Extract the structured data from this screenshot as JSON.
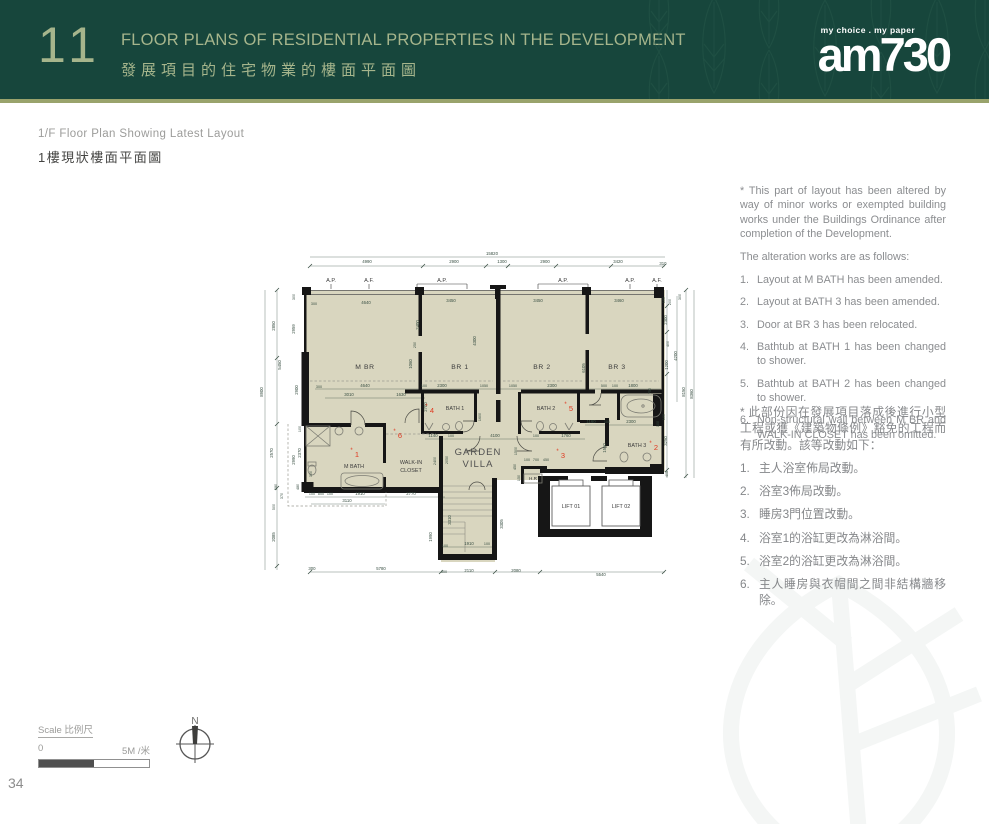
{
  "header": {
    "number": "11",
    "title_en": "FLOOR PLANS OF RESIDENTIAL PROPERTIES IN THE DEVELOPMENT",
    "title_zh": "發展項目的住宅物業的樓面平面圖",
    "logo_tagline": "my choice . my paper",
    "logo_name": "am730",
    "colors": {
      "band": "#17463c",
      "rule": "#99a36c",
      "title": "#a6b58c"
    }
  },
  "subtitle": {
    "en": "1/F Floor Plan Showing Latest Layout",
    "zh": "1樓現狀樓面平面圖"
  },
  "notes_en": {
    "intro": "* This part of layout has been altered by way of minor works or exempted building works under the Buildings Ordinance after completion of the Development.",
    "lead": "The alteration works are as follows:",
    "items": [
      "Layout at M BATH has been amended.",
      "Layout at BATH 3 has been amended.",
      "Door at BR 3 has been relocated.",
      "Bathtub at BATH 1 has been changed to shower.",
      "Bathtub at BATH 2 has been changed to shower.",
      "Non-structural wall between M BR and WALK-IN CLOSET has been omitted."
    ]
  },
  "notes_zh": {
    "intro": "* 此部份因在發展項目落成後進行小型工程或獲《建築物條例》豁免的工程而有所改動。該等改動如下：",
    "items": [
      "主人浴室佈局改動。",
      "浴室3佈局改動。",
      "睡房3門位置改動。",
      "浴室1的浴缸更改為淋浴間。",
      "浴室2的浴缸更改為淋浴間。",
      "主人睡房與衣帽間之間非結構牆移除。"
    ]
  },
  "scale": {
    "label": "Scale 比例尺",
    "zero": "0",
    "five": "5M /米"
  },
  "compass": {
    "north": "N"
  },
  "page_number": "34",
  "plan": {
    "marker_prefix": "*",
    "colors": {
      "floor": "#d9d6bf",
      "wall": "#161616",
      "dim": "#3a5044",
      "marker": "#e0381f"
    },
    "markers": [
      {
        "n": "1",
        "x": 101,
        "y": 217
      },
      {
        "n": "2",
        "x": 400,
        "y": 210
      },
      {
        "n": "3",
        "x": 307,
        "y": 218
      },
      {
        "n": "4",
        "x": 176,
        "y": 173
      },
      {
        "n": "5",
        "x": 315,
        "y": 171
      },
      {
        "n": "6",
        "x": 144,
        "y": 198
      }
    ],
    "labels": [
      {
        "t": "15820",
        "x": 237,
        "y": 15
      },
      {
        "t": "4990",
        "x": 112,
        "y": 23
      },
      {
        "t": "2900",
        "x": 199,
        "y": 23
      },
      {
        "t": "1300",
        "x": 247,
        "y": 23
      },
      {
        "t": "2900",
        "x": 290,
        "y": 23
      },
      {
        "t": "3420",
        "x": 363,
        "y": 23
      },
      {
        "t": "310",
        "x": 408,
        "y": 25
      },
      {
        "t": "A.P.",
        "x": 76,
        "y": 42,
        "c": "ap"
      },
      {
        "t": "A.F.",
        "x": 114,
        "y": 42,
        "c": "ap"
      },
      {
        "t": "A.P.",
        "x": 187,
        "y": 42,
        "c": "ap"
      },
      {
        "t": "A.P.",
        "x": 308,
        "y": 42,
        "c": "ap"
      },
      {
        "t": "A.P.",
        "x": 375,
        "y": 42,
        "c": "ap"
      },
      {
        "t": "A.F.",
        "x": 402,
        "y": 42,
        "c": "ap"
      },
      {
        "t": "300",
        "x": 59,
        "y": 65,
        "c": "tiny"
      },
      {
        "t": "4640",
        "x": 111,
        "y": 64
      },
      {
        "t": "3450",
        "x": 196,
        "y": 62
      },
      {
        "t": "3450",
        "x": 283,
        "y": 62
      },
      {
        "t": "3460",
        "x": 364,
        "y": 62
      },
      {
        "t": "100",
        "x": 410,
        "y": 60,
        "r": -90,
        "c": "tiny"
      },
      {
        "t": "200",
        "x": 416,
        "y": 62,
        "r": -90,
        "c": "tiny"
      },
      {
        "t": "8900",
        "x": 8,
        "y": 152,
        "r": -90
      },
      {
        "t": "2850",
        "x": 20,
        "y": 86,
        "r": -90
      },
      {
        "t": "5450",
        "x": 26,
        "y": 125,
        "r": -90
      },
      {
        "t": "2570",
        "x": 18,
        "y": 213,
        "r": -90
      },
      {
        "t": "580",
        "x": 22,
        "y": 247,
        "r": -90,
        "c": "tiny"
      },
      {
        "t": "370",
        "x": 28,
        "y": 256,
        "r": -90,
        "c": "tiny"
      },
      {
        "t": "500",
        "x": 20,
        "y": 267,
        "r": -90,
        "c": "tiny"
      },
      {
        "t": "2085",
        "x": 20,
        "y": 297,
        "r": -90
      },
      {
        "t": "300",
        "x": 40,
        "y": 57,
        "r": -90,
        "c": "tiny"
      },
      {
        "t": "2959",
        "x": 40,
        "y": 89,
        "r": -90
      },
      {
        "t": "2900",
        "x": 43,
        "y": 150,
        "r": -90
      },
      {
        "t": "100",
        "x": 46,
        "y": 189,
        "r": -90,
        "c": "tiny"
      },
      {
        "t": "2370",
        "x": 46,
        "y": 213,
        "r": -90
      },
      {
        "t": "2990",
        "x": 40,
        "y": 220,
        "r": -90
      },
      {
        "t": "480",
        "x": 44,
        "y": 247,
        "r": -90,
        "c": "tiny"
      },
      {
        "t": "300",
        "x": 57,
        "y": 234,
        "r": -90,
        "c": "tiny"
      },
      {
        "t": "300",
        "x": 426,
        "y": 57,
        "r": -90,
        "c": "tiny"
      },
      {
        "t": "2300",
        "x": 412,
        "y": 80,
        "r": -90
      },
      {
        "t": "400",
        "x": 414,
        "y": 104,
        "r": -90,
        "c": "tiny"
      },
      {
        "t": "1200",
        "x": 413,
        "y": 125,
        "r": -90
      },
      {
        "t": "4200",
        "x": 422,
        "y": 116,
        "r": -90
      },
      {
        "t": "8150",
        "x": 430,
        "y": 152,
        "r": -90
      },
      {
        "t": "8360",
        "x": 438,
        "y": 154,
        "r": -90
      },
      {
        "t": "3250",
        "x": 412,
        "y": 201,
        "r": -90
      },
      {
        "t": "405",
        "x": 413,
        "y": 234,
        "r": -90,
        "c": "tiny"
      },
      {
        "t": "100",
        "x": 410,
        "y": 177,
        "r": -90,
        "c": "tiny"
      },
      {
        "t": "300",
        "x": 57,
        "y": 330
      },
      {
        "t": "5780",
        "x": 126,
        "y": 330
      },
      {
        "t": "300",
        "x": 189,
        "y": 333,
        "c": "tiny"
      },
      {
        "t": "2110",
        "x": 214,
        "y": 332
      },
      {
        "t": "2080",
        "x": 261,
        "y": 332
      },
      {
        "t": "5540",
        "x": 346,
        "y": 336
      },
      {
        "t": "300",
        "x": 64,
        "y": 148,
        "c": "tiny"
      },
      {
        "t": "4640",
        "x": 110,
        "y": 147
      },
      {
        "t": "100",
        "x": 169,
        "y": 147,
        "c": "tiny"
      },
      {
        "t": "2300",
        "x": 187,
        "y": 147
      },
      {
        "t": "1050",
        "x": 229,
        "y": 147,
        "c": "tiny"
      },
      {
        "t": "1050",
        "x": 258,
        "y": 147,
        "c": "tiny"
      },
      {
        "t": "2300",
        "x": 297,
        "y": 147
      },
      {
        "t": "500",
        "x": 349,
        "y": 147,
        "c": "tiny"
      },
      {
        "t": "100",
        "x": 360,
        "y": 147,
        "c": "tiny"
      },
      {
        "t": "1800",
        "x": 378,
        "y": 147
      },
      {
        "t": "750",
        "x": 396,
        "y": 151,
        "r": -90,
        "c": "tiny"
      },
      {
        "t": "3010",
        "x": 94,
        "y": 156
      },
      {
        "t": "1630",
        "x": 146,
        "y": 156
      },
      {
        "t": "2400",
        "x": 164,
        "y": 85,
        "r": -90
      },
      {
        "t": "250",
        "x": 161,
        "y": 105,
        "r": -90,
        "c": "tiny"
      },
      {
        "t": "1060",
        "x": 157,
        "y": 124,
        "r": -90
      },
      {
        "t": "4300",
        "x": 221,
        "y": 101,
        "r": -90
      },
      {
        "t": "6105",
        "x": 330,
        "y": 128,
        "r": -90
      },
      {
        "t": "2700",
        "x": 172,
        "y": 167,
        "r": -90
      },
      {
        "t": "1600",
        "x": 226,
        "y": 177,
        "r": -90,
        "c": "tiny"
      },
      {
        "t": "1550",
        "x": 351,
        "y": 208,
        "r": -90
      },
      {
        "t": "1500",
        "x": 262,
        "y": 211,
        "r": -90,
        "c": "tiny"
      },
      {
        "t": "2400",
        "x": 181,
        "y": 221,
        "r": -90,
        "c": "tiny"
      },
      {
        "t": "2050",
        "x": 193,
        "y": 220,
        "r": -90,
        "c": "tiny"
      },
      {
        "t": "1140",
        "x": 178,
        "y": 197
      },
      {
        "t": "100",
        "x": 196,
        "y": 197,
        "c": "tiny"
      },
      {
        "t": "4100",
        "x": 240,
        "y": 197
      },
      {
        "t": "100",
        "x": 281,
        "y": 197,
        "c": "tiny"
      },
      {
        "t": "1760",
        "x": 311,
        "y": 197
      },
      {
        "t": "1160",
        "x": 336,
        "y": 183
      },
      {
        "t": "100",
        "x": 352,
        "y": 183,
        "c": "tiny"
      },
      {
        "t": "2300",
        "x": 376,
        "y": 183
      },
      {
        "t": "100",
        "x": 404,
        "y": 184,
        "r": -90,
        "c": "tiny"
      },
      {
        "t": "100",
        "x": 57,
        "y": 255,
        "c": "tiny"
      },
      {
        "t": "800",
        "x": 66,
        "y": 255,
        "c": "tiny"
      },
      {
        "t": "100",
        "x": 75,
        "y": 255,
        "c": "tiny"
      },
      {
        "t": "1910",
        "x": 105,
        "y": 255
      },
      {
        "t": "2770",
        "x": 156,
        "y": 255
      },
      {
        "t": "3110",
        "x": 92,
        "y": 262
      },
      {
        "t": "3310",
        "x": 196,
        "y": 280,
        "r": -90
      },
      {
        "t": "1990",
        "x": 177,
        "y": 297,
        "r": -90
      },
      {
        "t": "1910",
        "x": 214,
        "y": 305
      },
      {
        "t": "100",
        "x": 190,
        "y": 307,
        "c": "tiny"
      },
      {
        "t": "100",
        "x": 232,
        "y": 305,
        "c": "tiny"
      },
      {
        "t": "3305",
        "x": 248,
        "y": 284,
        "r": -90
      },
      {
        "t": "100",
        "x": 272,
        "y": 221,
        "c": "tiny"
      },
      {
        "t": "700",
        "x": 281,
        "y": 221,
        "c": "tiny"
      },
      {
        "t": "450",
        "x": 291,
        "y": 221,
        "c": "tiny"
      },
      {
        "t": "450",
        "x": 261,
        "y": 227,
        "r": -90,
        "c": "tiny"
      },
      {
        "t": "150",
        "x": 265,
        "y": 238,
        "r": -90,
        "c": "tiny"
      },
      {
        "t": "M BR",
        "x": 110,
        "y": 129,
        "c": "room"
      },
      {
        "t": "BR 1",
        "x": 205,
        "y": 129,
        "c": "room"
      },
      {
        "t": "BR 2",
        "x": 287,
        "y": 129,
        "c": "room"
      },
      {
        "t": "BR 3",
        "x": 362,
        "y": 129,
        "c": "room"
      },
      {
        "t": "BATH 1",
        "x": 200,
        "y": 170,
        "c": "room-s"
      },
      {
        "t": "BATH 2",
        "x": 291,
        "y": 170,
        "c": "room-s"
      },
      {
        "t": "BATH 3",
        "x": 382,
        "y": 207,
        "c": "room-s"
      },
      {
        "t": "M BATH",
        "x": 99,
        "y": 228,
        "c": "room-s"
      },
      {
        "t": "WALK-IN",
        "x": 156,
        "y": 224,
        "c": "room-s"
      },
      {
        "t": "CLOSET",
        "x": 156,
        "y": 232,
        "c": "room-s"
      },
      {
        "t": "GARDEN",
        "x": 223,
        "y": 215,
        "c": "room-lg"
      },
      {
        "t": "VILLA",
        "x": 223,
        "y": 227,
        "c": "room-lg"
      },
      {
        "t": "H.R",
        "x": 278,
        "y": 240,
        "c": "tiny2"
      },
      {
        "t": "LIFT 01",
        "x": 316,
        "y": 268,
        "c": "room-s"
      },
      {
        "t": "LIFT 02",
        "x": 366,
        "y": 268,
        "c": "room-s"
      }
    ]
  }
}
